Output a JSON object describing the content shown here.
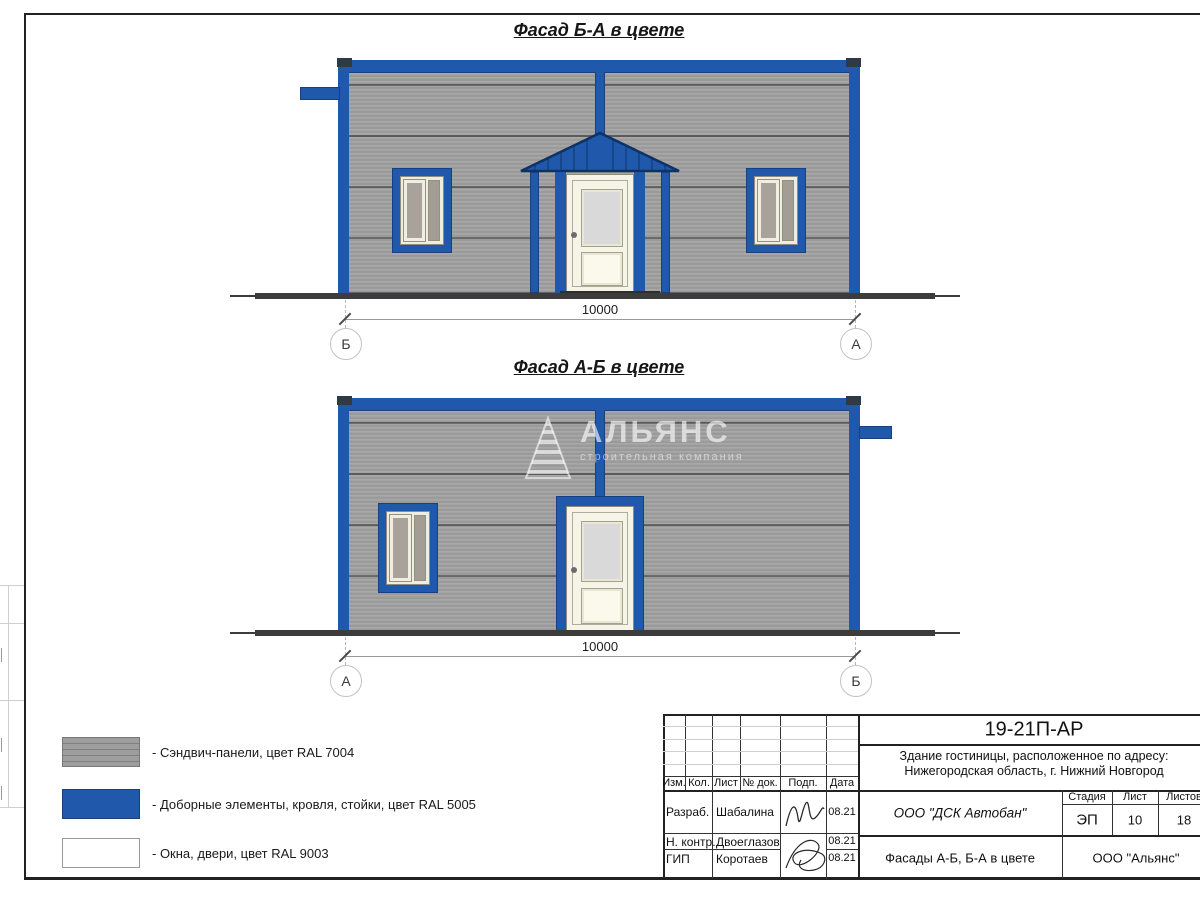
{
  "facades": [
    {
      "title": "Фасад Б-А в цвете",
      "dimension": "10000",
      "axis_left": "Б",
      "axis_right": "А"
    },
    {
      "title": "Фасад А-Б в цвете",
      "dimension": "10000",
      "axis_left": "А",
      "axis_right": "Б"
    }
  ],
  "watermark": {
    "name": "АЛЬЯНС",
    "subtitle": "строительная компания"
  },
  "legend": {
    "items": [
      {
        "label": "- Сэндвич-панели, цвет RAL 7004",
        "color": "#9e9e9e"
      },
      {
        "label": "- Доборные элементы, кровля, стойки, цвет RAL 5005",
        "color": "#2059ac"
      },
      {
        "label": "- Окна, двери, цвет RAL 9003",
        "color": "#ffffff"
      }
    ]
  },
  "title_block": {
    "doc_number": "19-21П-АР",
    "address_line1": "Здание гостиницы, расположенное по адресу:",
    "address_line2": "Нижегородская область, г. Нижний Новгород",
    "columns": [
      "Изм.",
      "Кол.",
      "Лист",
      "№ док.",
      "Подп.",
      "Дата"
    ],
    "rows": [
      {
        "role": "Разраб.",
        "name": "Шабалина",
        "date": "08.21"
      },
      {
        "role": "Н. контр.",
        "name": "Двоеглазов",
        "date": "08.21"
      },
      {
        "role": "ГИП",
        "name": "Коротаев",
        "date": "08.21"
      }
    ],
    "company": "ООО \"ДСК Автобан\"",
    "sheet_title": "Фасады А-Б, Б-А в цвете",
    "organization": "ООО \"Альянс\"",
    "stage_label": "Стадия",
    "sheet_label": "Лист",
    "sheets_label": "Листов",
    "stage": "ЭП",
    "sheet_number": "10",
    "sheets_total": "18"
  },
  "colors": {
    "panel_gray": "#9e9e9e",
    "trim_blue": "#2059ac",
    "windows_white": "#ffffff",
    "ground": "#3c3c3c"
  }
}
